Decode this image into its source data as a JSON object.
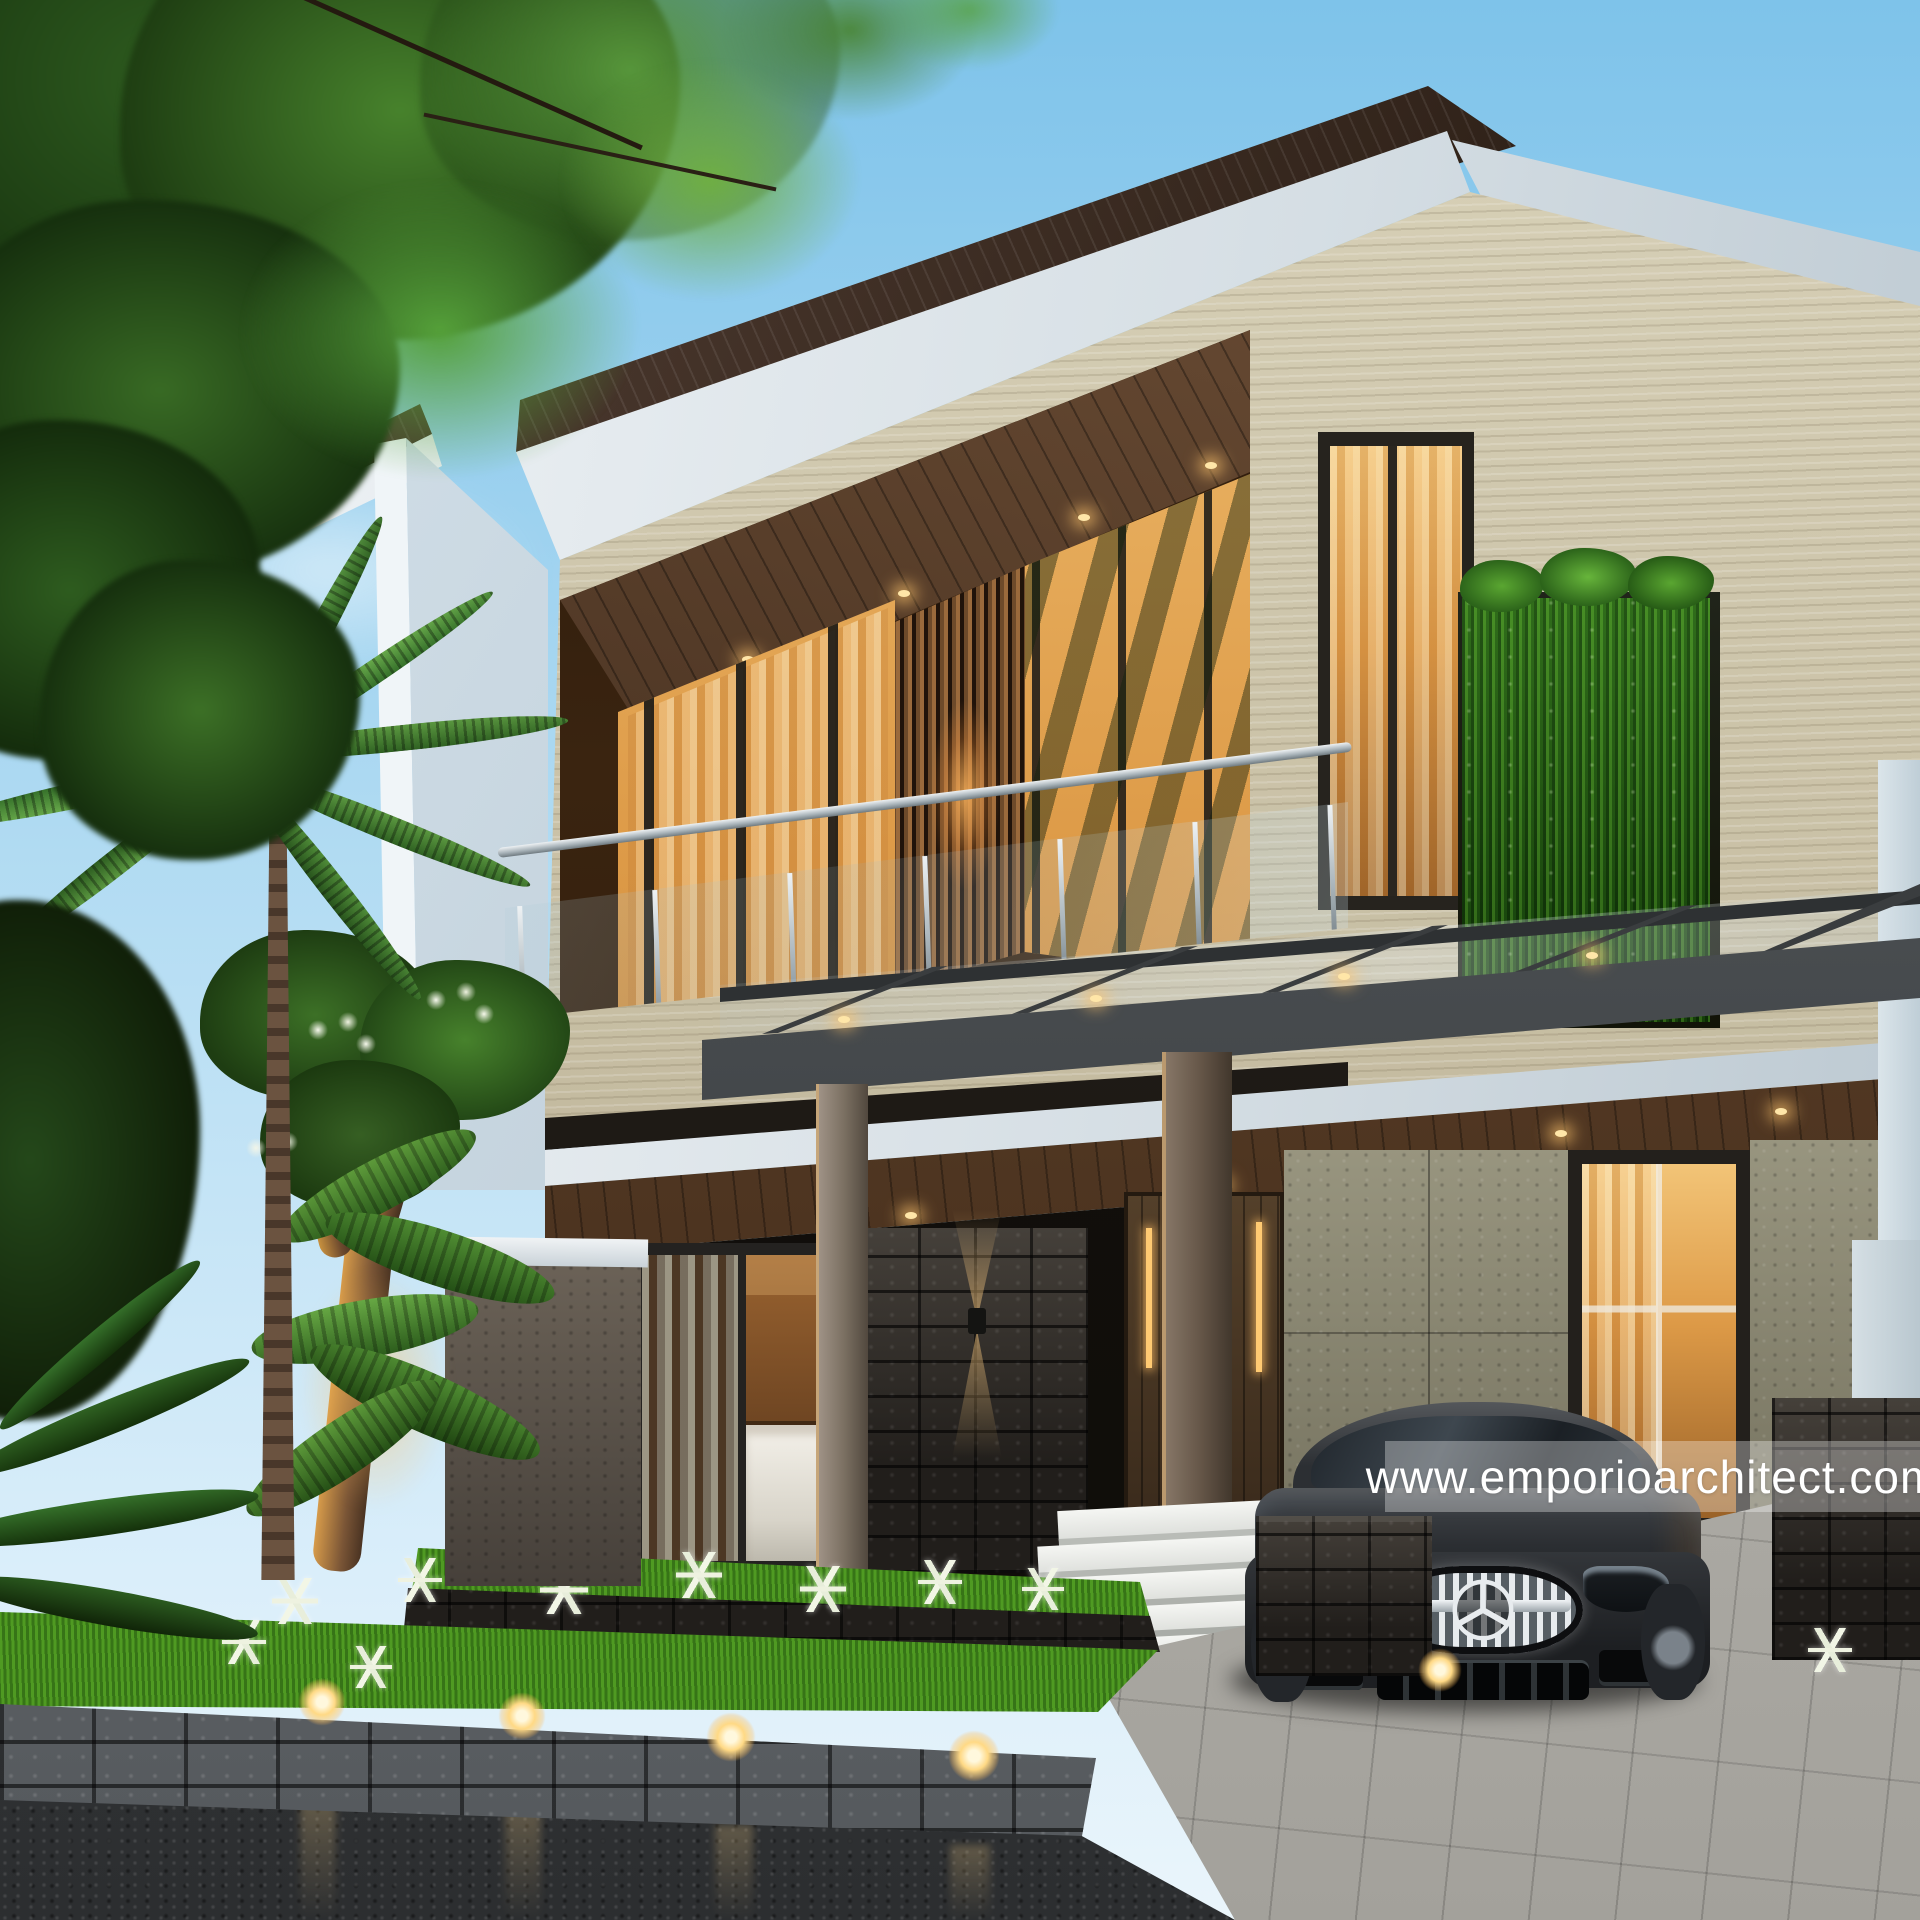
{
  "watermark": {
    "text": "www.emporioarchitect.com"
  },
  "palette": {
    "sky_top": "#7ec3ea",
    "sky_mid": "#b5ddf3",
    "sky_low": "#daeefa",
    "roof": "#31231a",
    "roof_hi": "#5a453a",
    "trav": "#c6bda2",
    "trav_hi": "#d9d2b9",
    "trav_shade": "#a1967b",
    "lava": "#211e1b",
    "lava_light": "#45403a",
    "greywall": "#98957f",
    "greywall_dark": "#73705d",
    "door": "#54402a",
    "grass": "#4f9a22",
    "grass_bright": "#86cf3a",
    "glow": "#ffcf7e",
    "band": "rgba(255,255,255,0.32)",
    "wm": "#ffffff"
  }
}
